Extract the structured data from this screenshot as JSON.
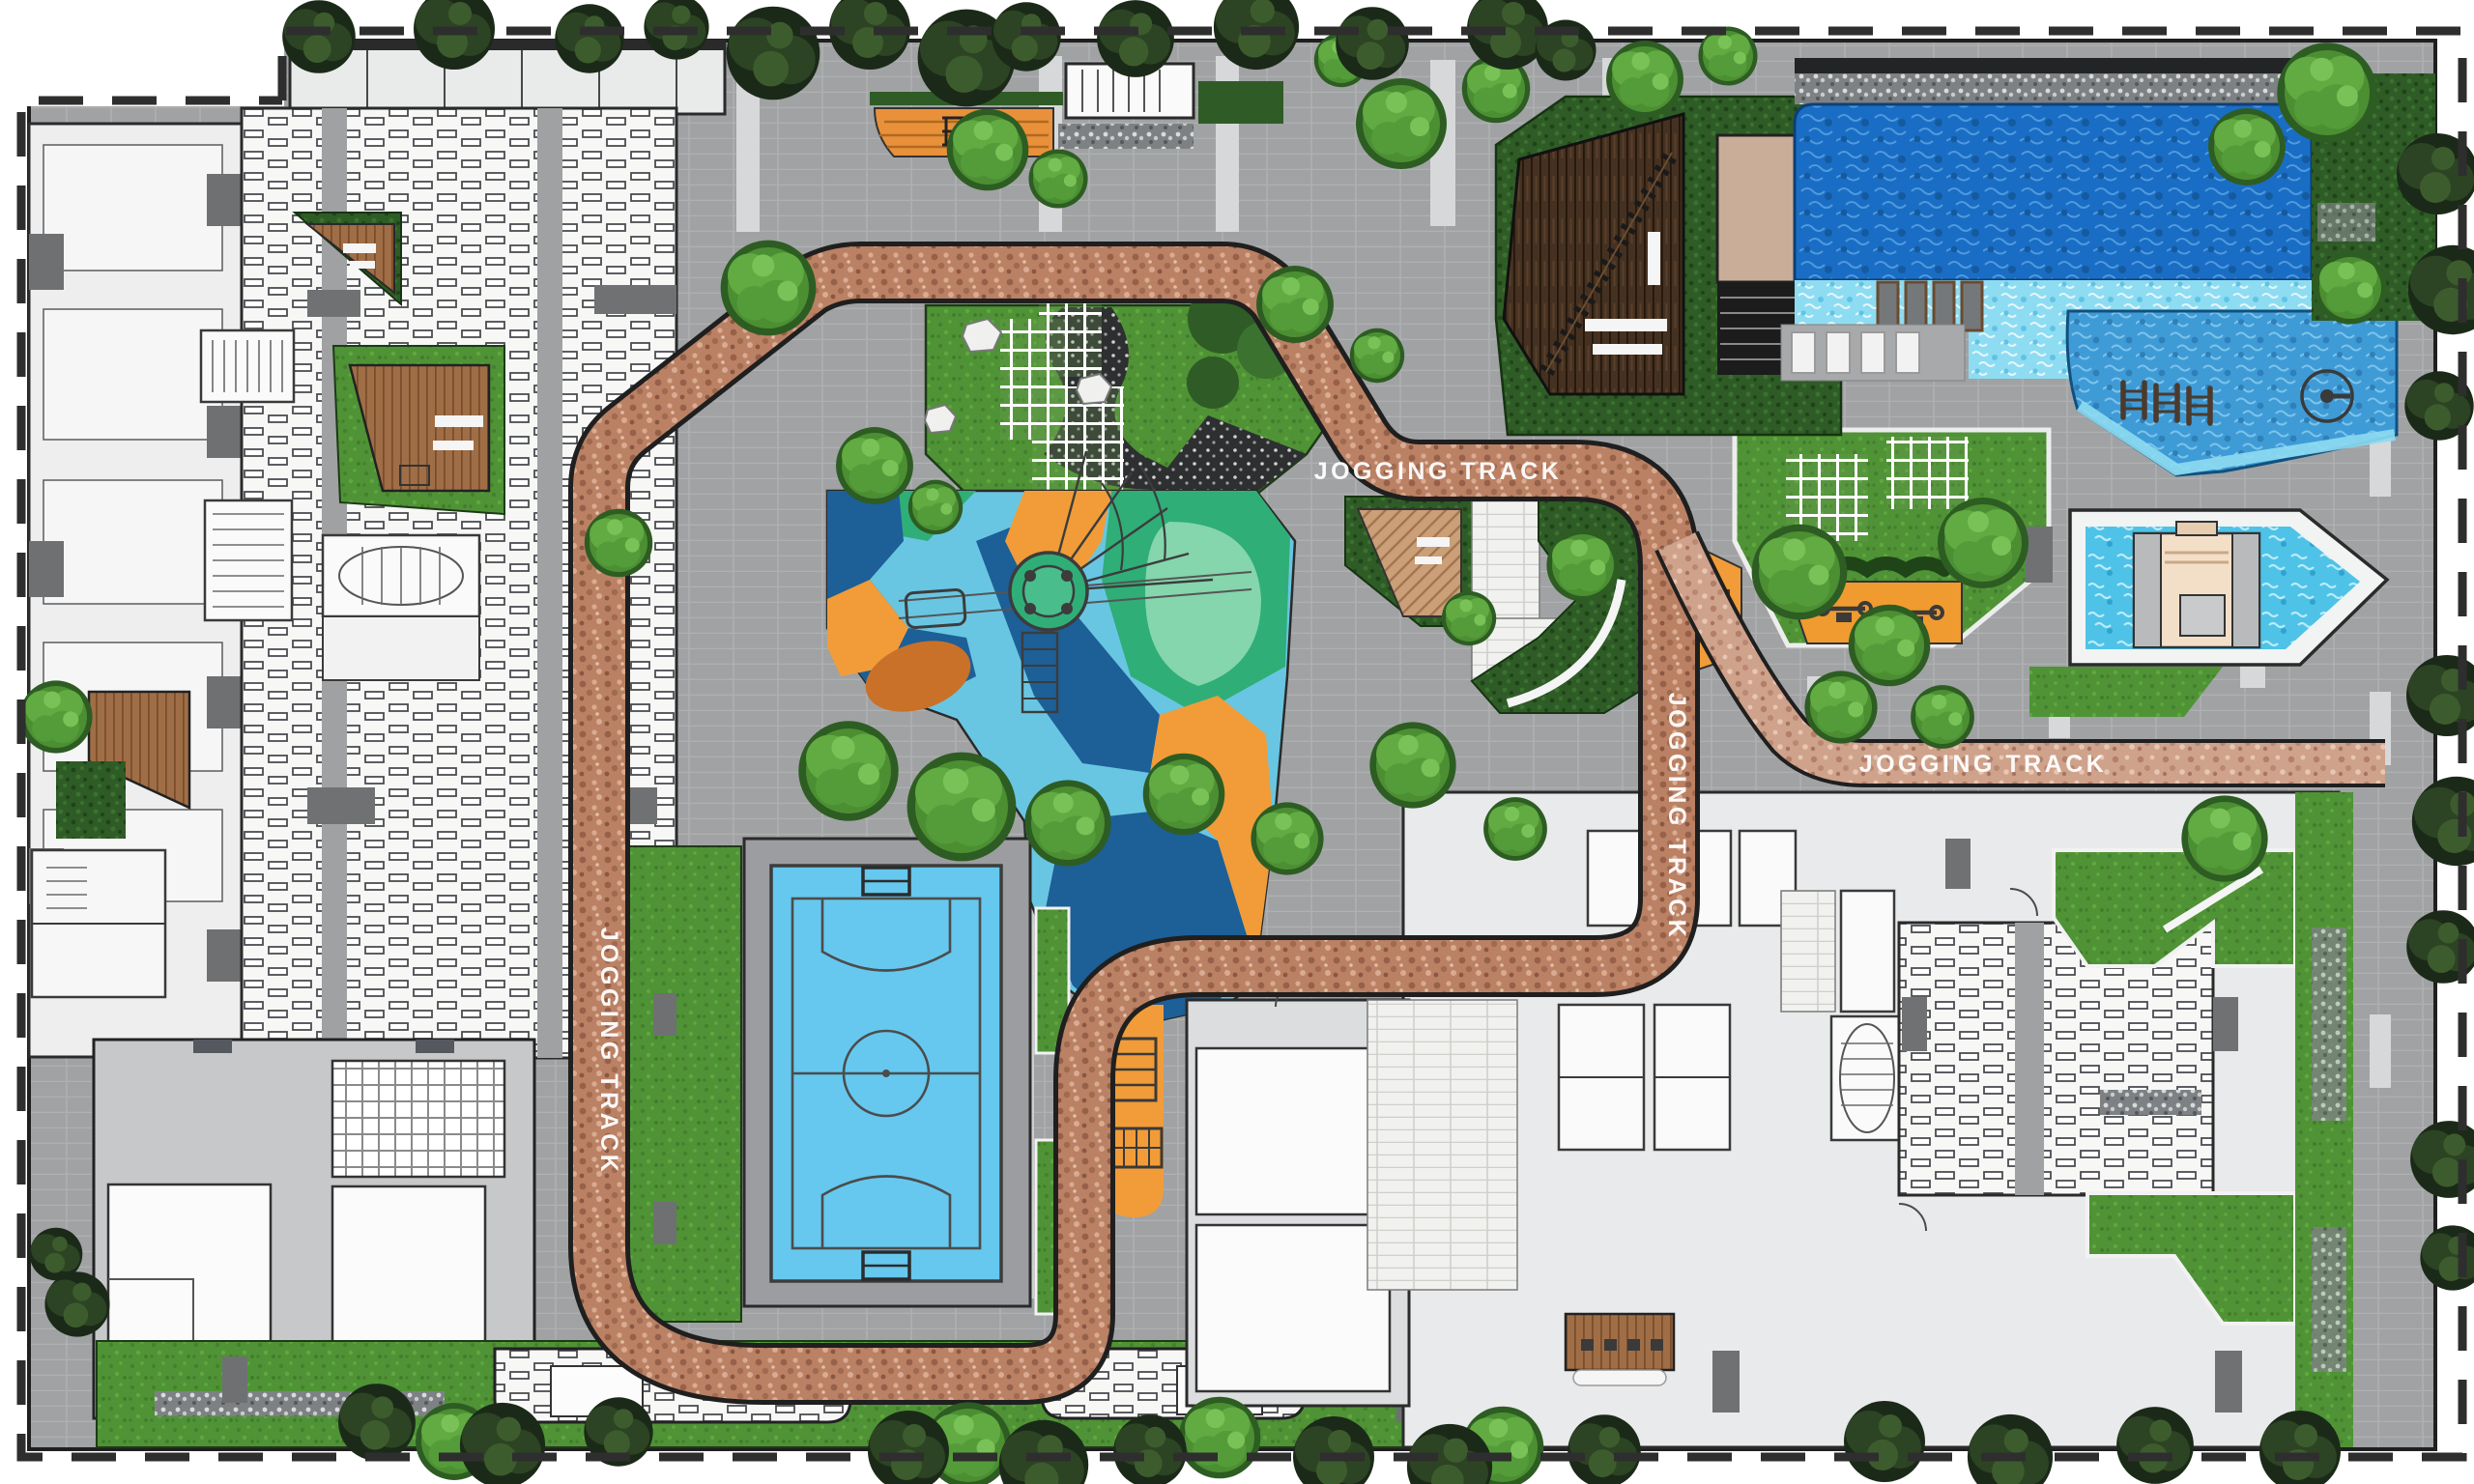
{
  "plan": {
    "labels": [
      {
        "text": "JOGGING TRACK",
        "orientation": "horizontal",
        "location": "center-loop"
      },
      {
        "text": "JOGGING TRACK",
        "orientation": "vertical",
        "location": "right-loop-segment"
      },
      {
        "text": "JOGGING TRACK",
        "orientation": "horizontal",
        "location": "east-branch"
      },
      {
        "text": "JOGGING TRACK",
        "orientation": "vertical",
        "location": "west-loop-segment"
      }
    ],
    "features": [
      "site-boundary-dashed-line",
      "jogging-track-loop",
      "futsal-court",
      "children-playground",
      "climbing-net-tower",
      "zipline",
      "pergola-trellis-garden",
      "central-plaza",
      "timber-deck-pavilion",
      "amphitheater-steps",
      "main-swimming-pool",
      "tanning-shelf-with-loungers",
      "lap-pool",
      "pool-ladders",
      "kids-pool-with-cabana",
      "outdoor-fitness-area",
      "residential-building-footprints",
      "stair-cores",
      "paved-roads-with-crossings",
      "lawns-and-hedges",
      "perimeter-trees",
      "wooden-decks"
    ],
    "counts": {
      "jogging_track_labels": 4,
      "in_water_loungers": 4,
      "deck_loungers": 4,
      "pool_ladders": 3,
      "fitness_equipment": 2
    },
    "palette": {
      "background": "#ffffff",
      "boundary_dash": "#2e2e2e",
      "road_gray": "#a0a2a4",
      "paving_light": "#ebecec",
      "track_terracotta": "#bb8164",
      "track_light": "#cfa28b",
      "grass_green": "#4f9336",
      "hedge_green": "#2f5c26",
      "pool_deep_blue": "#1a6dc4",
      "pool_mid_blue": "#3f9bd6",
      "pool_light_aqua": "#8edcf2",
      "kids_pool_aqua": "#4fc2e8",
      "futsal_court_blue": "#66c8ee",
      "playground_orange": "#f19c38",
      "playground_dark_blue": "#1d5f97",
      "playground_light_blue": "#69c6e2",
      "playground_teal": "#2fae78",
      "timber_dark": "#4a3423",
      "timber_brown": "#9a6a44",
      "terrace_tan": "#c9ad99",
      "label_text": "#ffffff"
    }
  }
}
